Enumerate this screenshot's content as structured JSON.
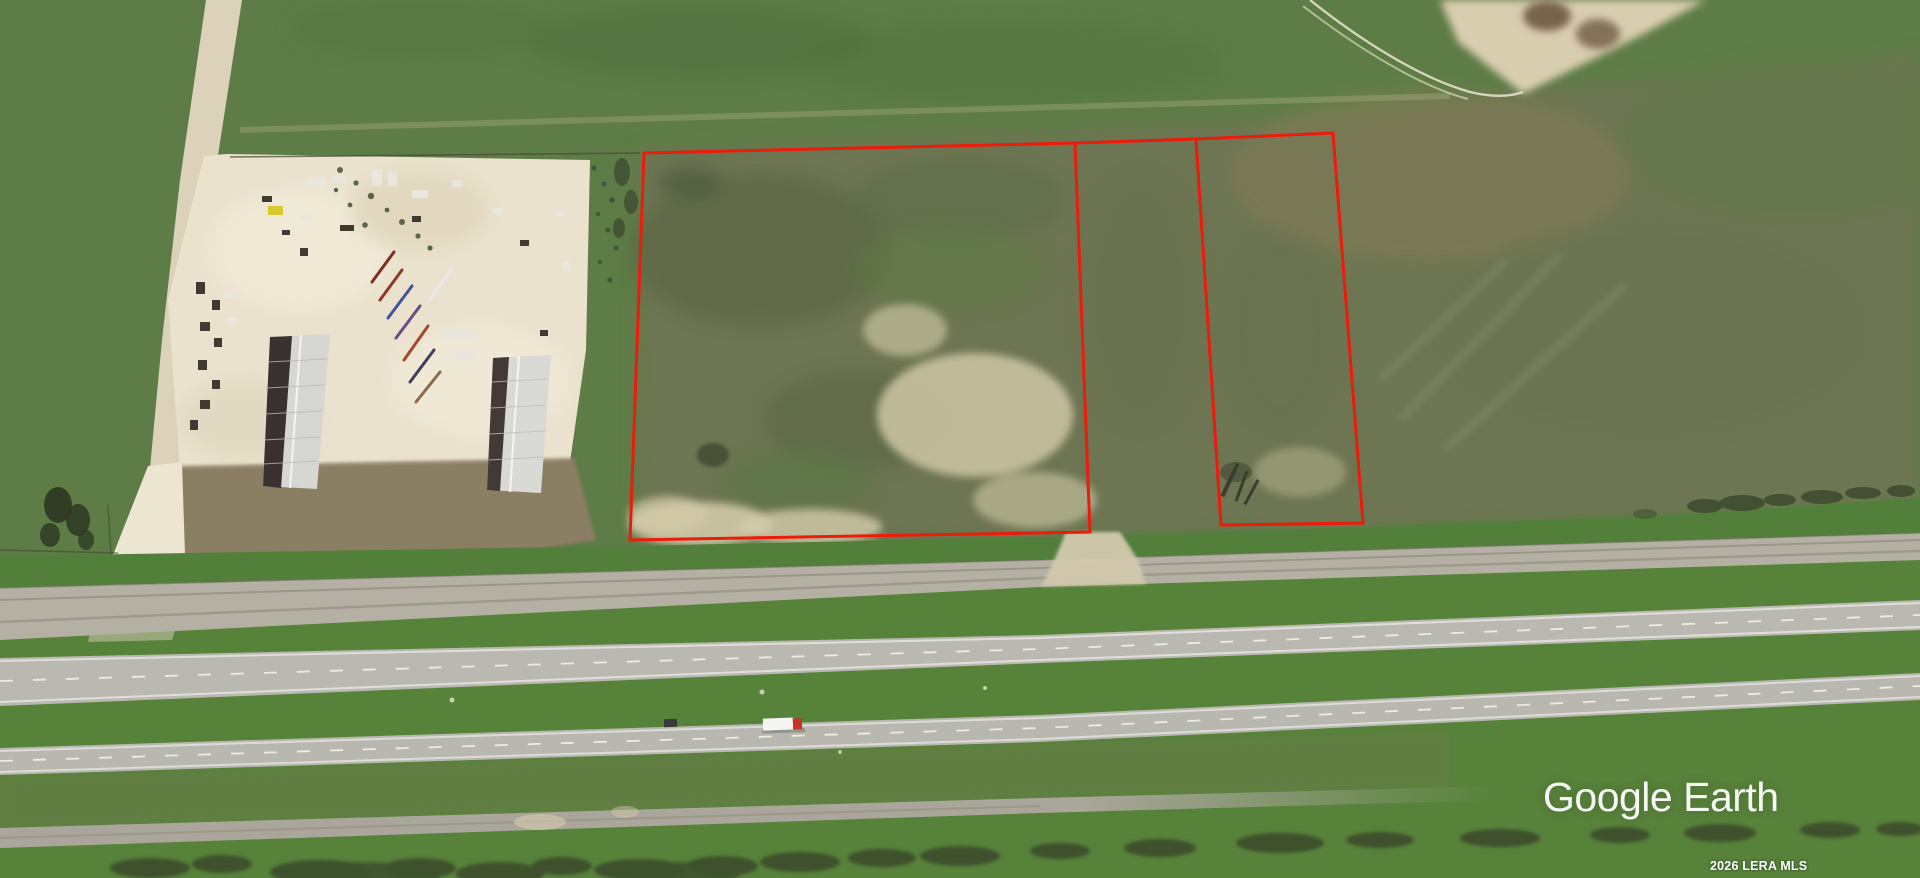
{
  "view": {
    "kind": "satellite-aerial-imagery",
    "watermark": "Google Earth",
    "attribution": "2026 LERA MLS"
  },
  "overlay": {
    "outline_color": "#ee1a0a",
    "outlined_parcels": 2,
    "connector_segments": 1
  },
  "palette": {
    "field_green": "#5e7d46",
    "verge_green": "#52803a",
    "scrub_olive": "#6f7454",
    "road_gray": "#b9b8b0",
    "service_road_gray": "#b4b0a3",
    "gravel_cream": "#eae2cd",
    "apron_brown": "#8f7e66",
    "dirt_tan": "#d9cdb0",
    "roof_light": "#d6d6d3",
    "roof_dark": "#3a3230",
    "brush_dark": "#3a4a2c",
    "truck_red": "#c63428",
    "truck_white": "#f4f4f2"
  }
}
